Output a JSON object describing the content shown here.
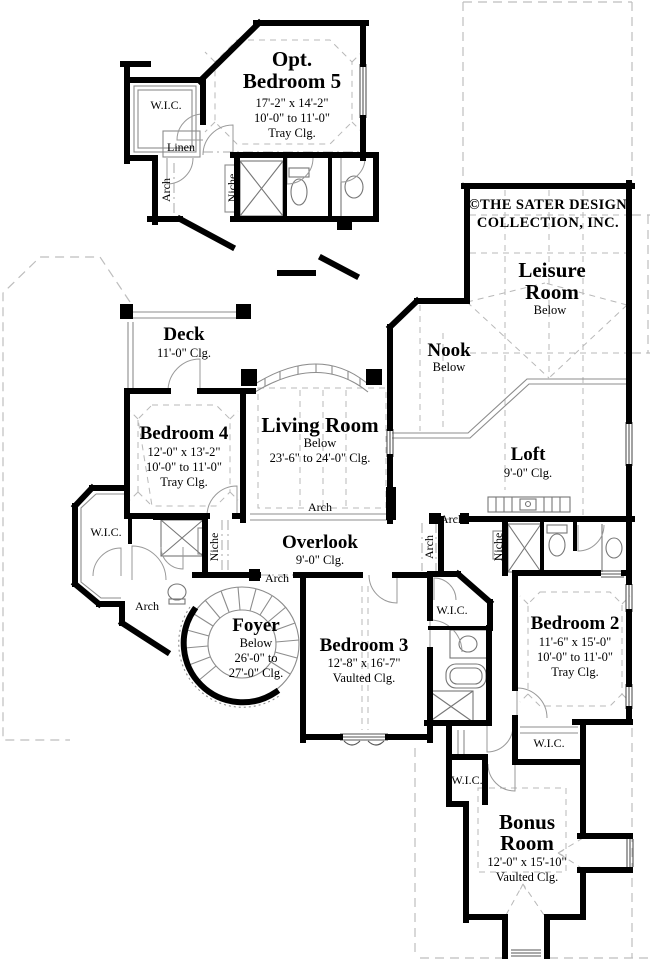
{
  "copyright": {
    "line1": "©THE SATER DESIGN",
    "line2": "COLLECTION, INC."
  },
  "rooms": {
    "opt_bedroom5": {
      "line1": "Opt.",
      "line2": "Bedroom 5",
      "dim": "17'-2\" x 14'-2\"",
      "ceil": "10'-0\" to 11'-0\"",
      "ceil2": "Tray Clg."
    },
    "leisure_room": {
      "line1": "Leisure",
      "line2": "Room",
      "note": "Below"
    },
    "nook": {
      "name": "Nook",
      "note": "Below"
    },
    "deck": {
      "name": "Deck",
      "ceil": "11'-0\" Clg."
    },
    "bedroom4": {
      "name": "Bedroom 4",
      "dim": "12'-0\" x 13'-2\"",
      "ceil": "10'-0\" to 11'-0\"",
      "ceil2": "Tray Clg."
    },
    "living_room": {
      "name": "Living Room",
      "note": "Below",
      "ceil": "23'-6\" to 24'-0\" Clg."
    },
    "loft": {
      "name": "Loft",
      "ceil": "9'-0\" Clg."
    },
    "overlook": {
      "name": "Overlook",
      "ceil": "9'-0\" Clg."
    },
    "foyer": {
      "name": "Foyer",
      "note": "Below",
      "ceil": "26'-0\" to",
      "ceil2": "27'-0\" Clg."
    },
    "bedroom3": {
      "name": "Bedroom 3",
      "dim": "12'-8\" x 16'-7\"",
      "ceil": "Vaulted Clg."
    },
    "bedroom2": {
      "name": "Bedroom 2",
      "dim": "11'-6\" x 15'-0\"",
      "ceil": "10'-0\" to 11'-0\"",
      "ceil2": "Tray Clg."
    },
    "bonus_room": {
      "line1": "Bonus",
      "line2": "Room",
      "dim": "12'-0\" x 15'-10\"",
      "ceil": "Vaulted Clg."
    }
  },
  "labels": {
    "wic": "W.I.C.",
    "linen": "Linen",
    "arch": "Arch",
    "niche": "Niche"
  },
  "colors": {
    "wall": "#000000",
    "thin_line": "#8c8c8c",
    "dashed_line": "#b8b8b8",
    "background": "#ffffff",
    "text": "#000000"
  }
}
